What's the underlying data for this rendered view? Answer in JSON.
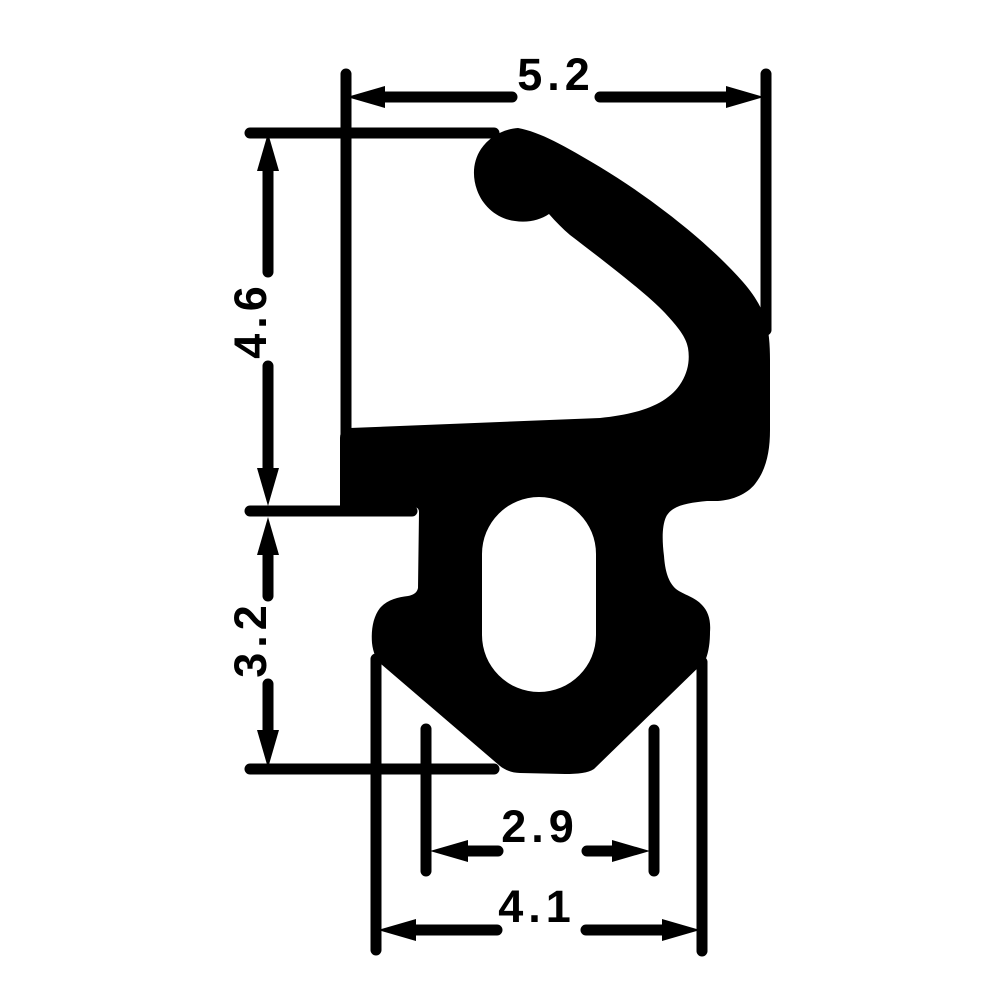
{
  "diagram": {
    "kind": "technical-profile-drawing",
    "subject": "rubber-seal-gasket-cross-section",
    "background_color": "#ffffff",
    "ink_color": "#000000",
    "dimensions": {
      "overall_width_top": "5.2",
      "upper_height": "4.6",
      "lower_height": "3.2",
      "stem_width": "2.9",
      "base_width": "4.1"
    }
  }
}
